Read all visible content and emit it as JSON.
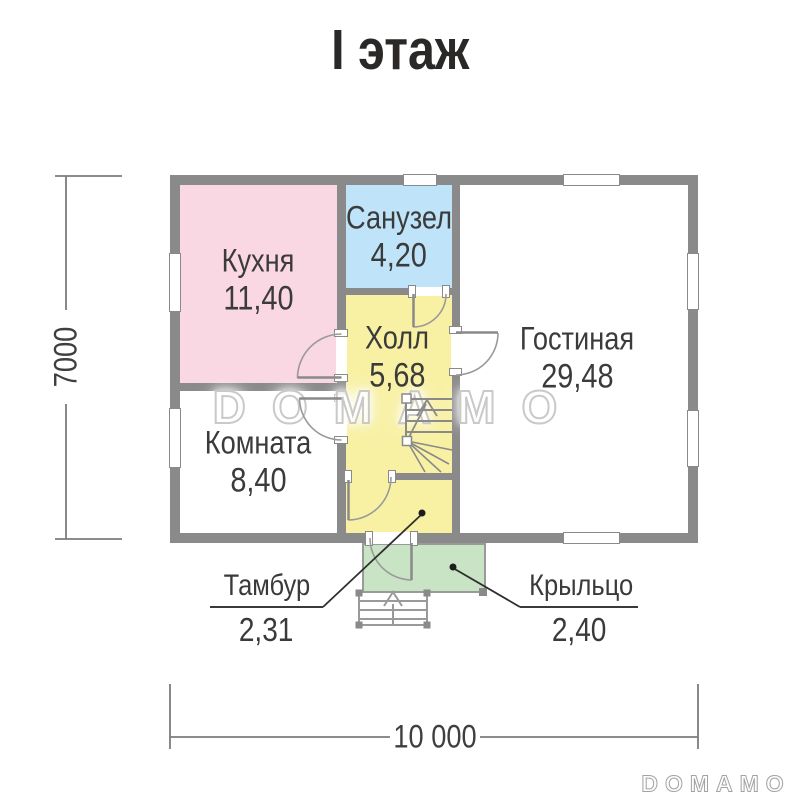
{
  "title": "I этаж",
  "rooms": [
    {
      "name": "Кухня",
      "area": "11,40"
    },
    {
      "name": "Санузел",
      "area": "4,20"
    },
    {
      "name": "Холл",
      "area": "5,68"
    },
    {
      "name": "Гостиная",
      "area": "29,48"
    },
    {
      "name": "Комната",
      "area": "8,40"
    },
    {
      "name": "Тамбур",
      "area": "2,31"
    },
    {
      "name": "Крыльцо",
      "area": "2,40"
    }
  ],
  "dimensions": {
    "total_width": "10 000",
    "total_height": "7000"
  },
  "watermark": "DOMAMO",
  "logo": "DOMAMO",
  "colors": {
    "wall": "#8a8a8a",
    "kitchen_fill": "#f9d7e3",
    "bathroom_fill": "#bfe3f8",
    "hall_fill": "#f8f1a4",
    "vestibule_fill": "#f8f1a4",
    "porch_fill": "#c9e4c4",
    "living_fill": "#ffffff",
    "room_fill": "#ffffff",
    "text": "#3b3b3b"
  }
}
